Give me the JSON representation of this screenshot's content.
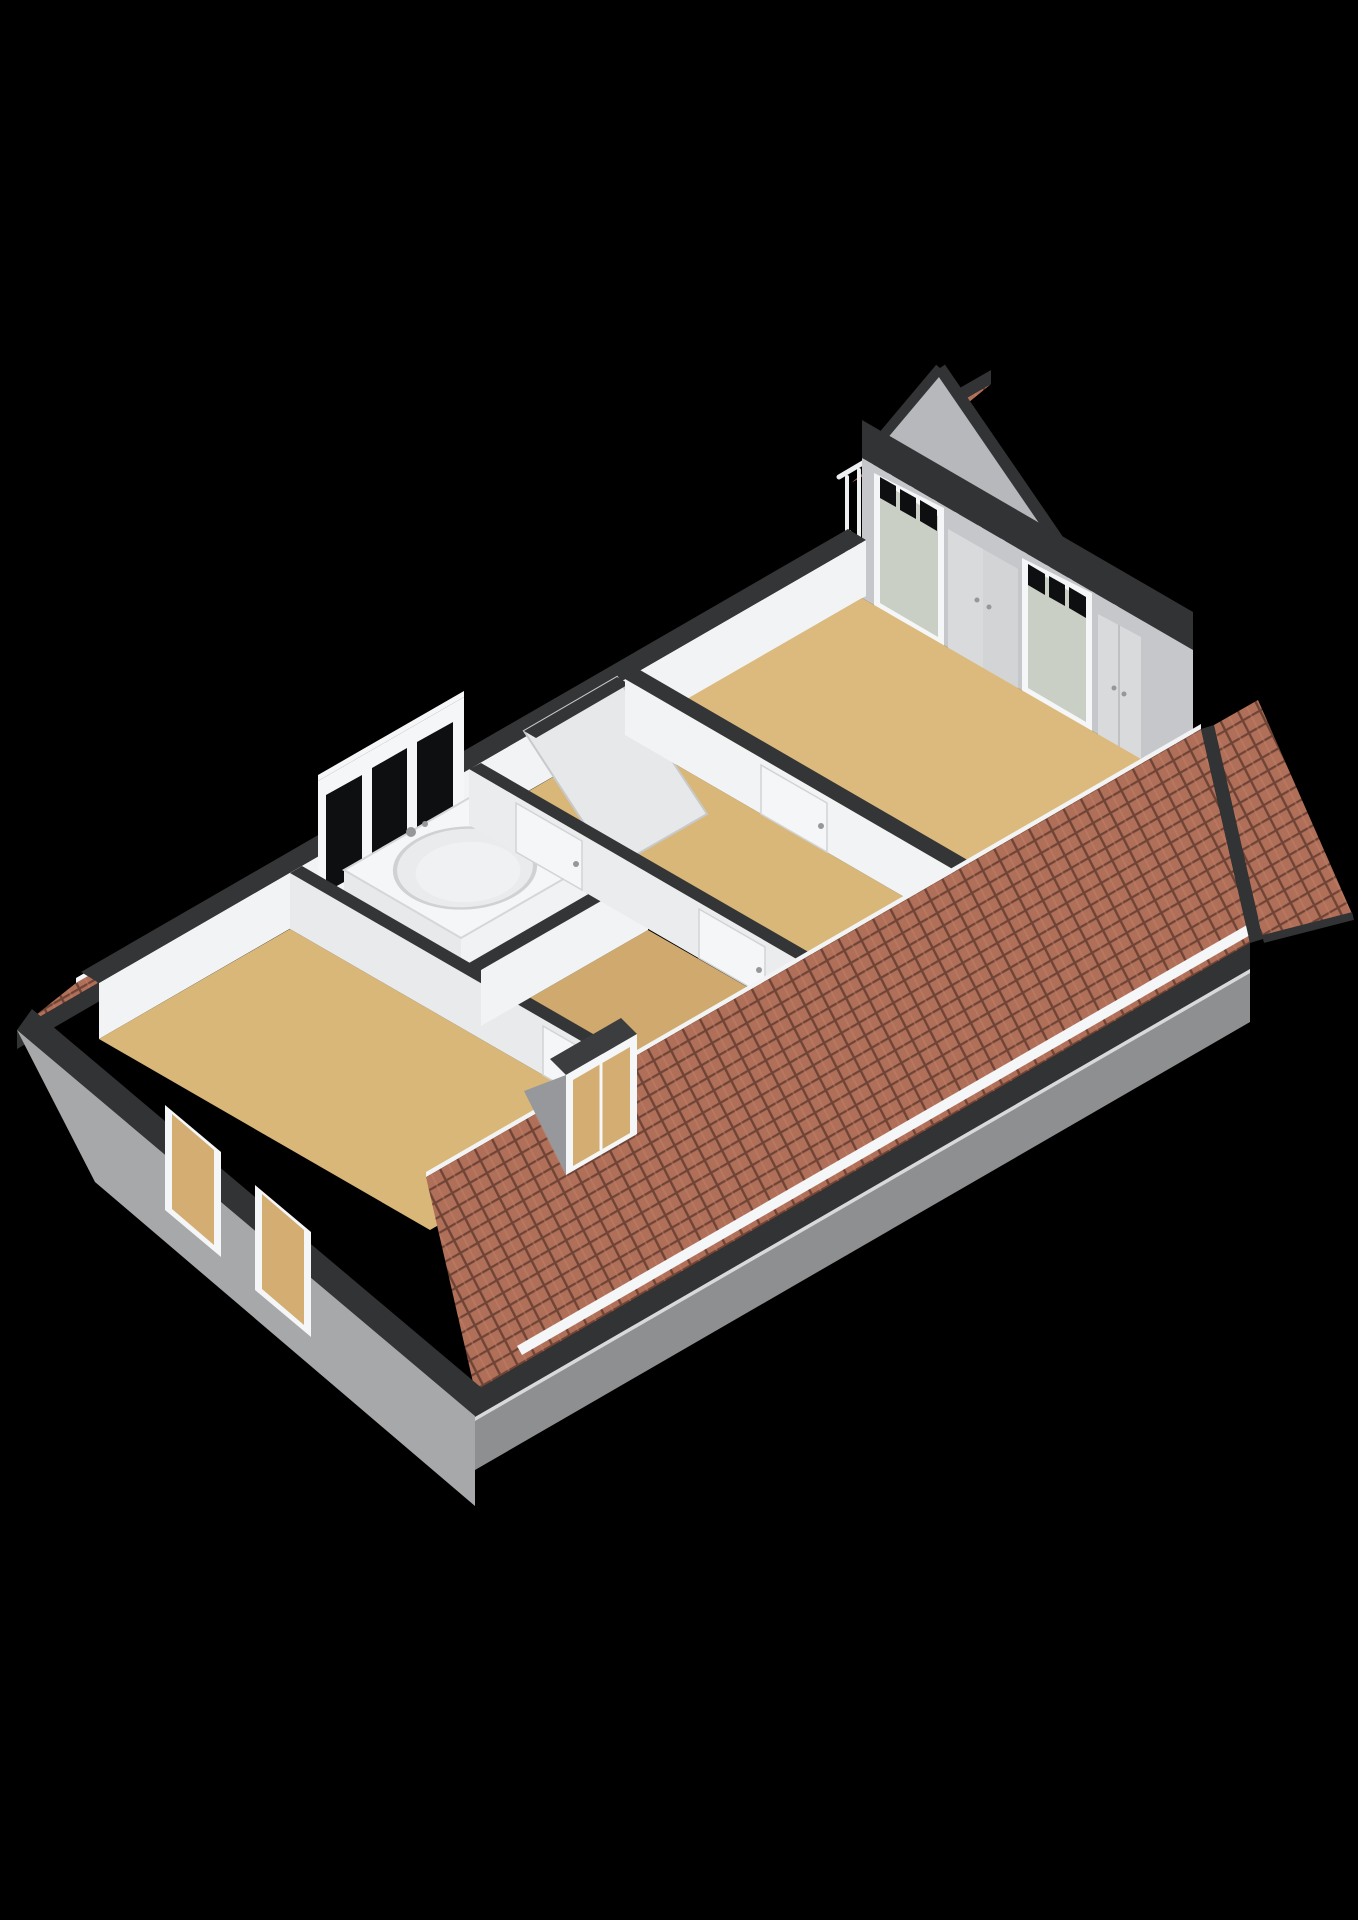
{
  "meta": {
    "view": "isometric-3d-floorplan-render",
    "floor_shown": "attic-floor",
    "background": "solid-black",
    "visible_text": "none"
  },
  "colors": {
    "background": "#000000",
    "roof_tile": "#b06f58",
    "roof_tile_gap": "#6f4436",
    "roof_tile_ridge": "#c8836a",
    "fascia_dark": "#323335",
    "wall_top": "#343537",
    "int_wall": "#f2f3f4",
    "int_wall_shade": "#e9eaec",
    "ext_wall": "#a7a8aa",
    "ext_wall_shadow": "#8e8f91",
    "white": "#f5f6f7",
    "floor_tan": "#d9b778",
    "floor_tan_dark": "#cfa96d",
    "floor_big": "#dcba7e",
    "bath_floor": "#e9eaec",
    "glass_dark": "#0e0f11",
    "glass_green": "#c9cfc5",
    "glass_tan": "#d3ad72",
    "deck": "#454648",
    "gable_triangle": "#b6b8bb",
    "end_wall": "#c5c7ca",
    "closet": "#d9dadc",
    "railing": "#eeeff0"
  },
  "scene": {
    "building": {
      "roof_type": "pitched-tiled",
      "roof_slopes": [
        "front-long-slope",
        "rear-strip-left",
        "rear-strip-right",
        "right-end-slope",
        "detached-ridge-piece"
      ],
      "gutter": "white-strip-along-front-eave"
    },
    "rooms": [
      {
        "name": "left-bedroom",
        "floor": "tan",
        "features": [
          "gable-window-upper",
          "gable-window-lower",
          "front-dormer-window",
          "door-to-landing"
        ]
      },
      {
        "name": "bathroom",
        "floor": "light-grey",
        "features": [
          "rear-window-band-3-panes",
          "corner-bathtub",
          "faucet",
          "door-to-landing"
        ]
      },
      {
        "name": "front-room",
        "floor": "tan",
        "features": [
          "door-to-landing"
        ]
      },
      {
        "name": "landing",
        "floor": "tan",
        "features": [
          "stair-hatch",
          "door-to-bathroom",
          "door-to-front-room",
          "door-to-big-room"
        ]
      },
      {
        "name": "big-attic-room",
        "floor": "tan",
        "features": [
          "rear-gable-peak",
          "terrace-door-left",
          "terrace-door-right",
          "built-in-closet-double",
          "built-in-closet-single"
        ]
      }
    ],
    "exterior": {
      "left_gable_windows": 2,
      "terrace": {
        "deck": "dark-flat-roof",
        "railing_posts_main": 11,
        "railing_posts_rear": 3
      }
    }
  }
}
